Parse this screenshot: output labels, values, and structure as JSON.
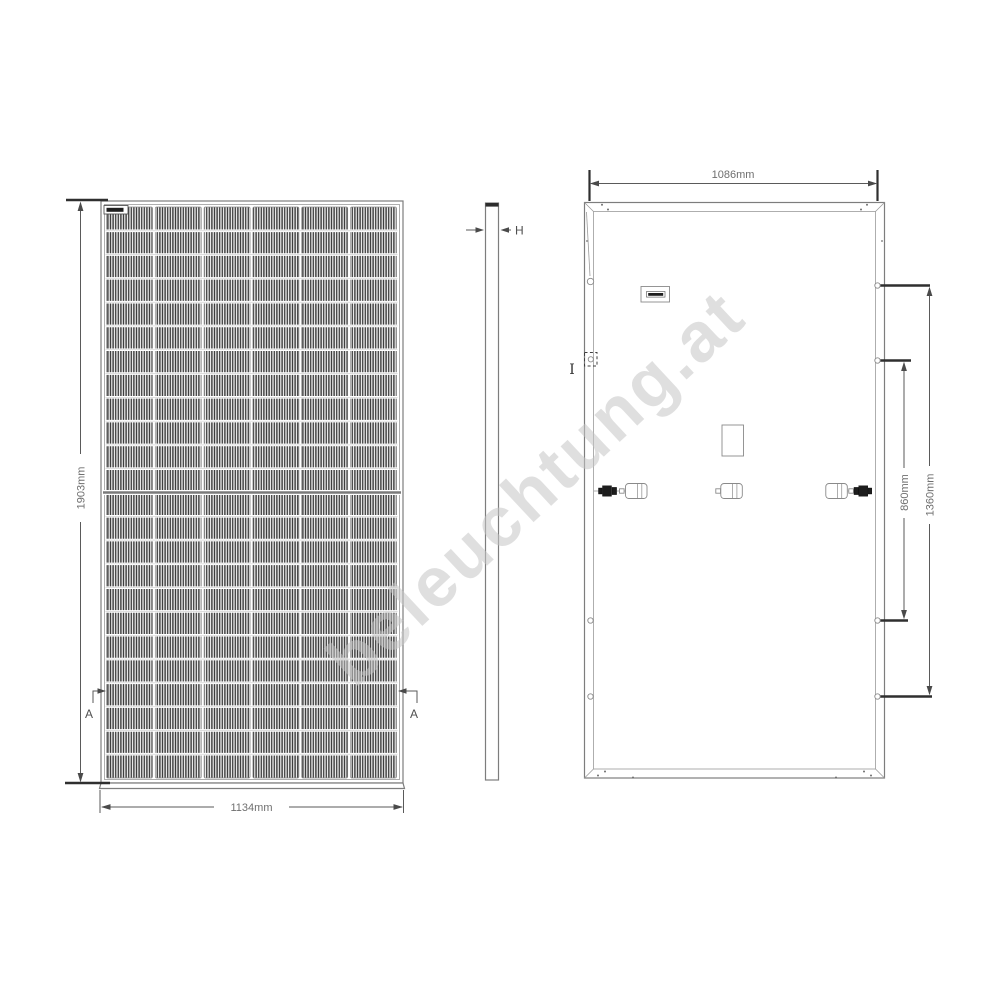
{
  "watermark": "beleuchtung.at",
  "front_view": {
    "height_label": "1903mm",
    "width_label": "1134mm",
    "section_marker_left": "A",
    "section_marker_right": "A"
  },
  "side_view": {
    "thickness_label": "H"
  },
  "back_view": {
    "width_label": "1086mm",
    "mount_hole_inner_label": "860mm",
    "mount_hole_outer_label": "1360mm",
    "detail_label": "I"
  },
  "colors": {
    "line": "#5a5a5a",
    "cell_stripe": "#383838",
    "watermark": "#c6c6c6"
  }
}
